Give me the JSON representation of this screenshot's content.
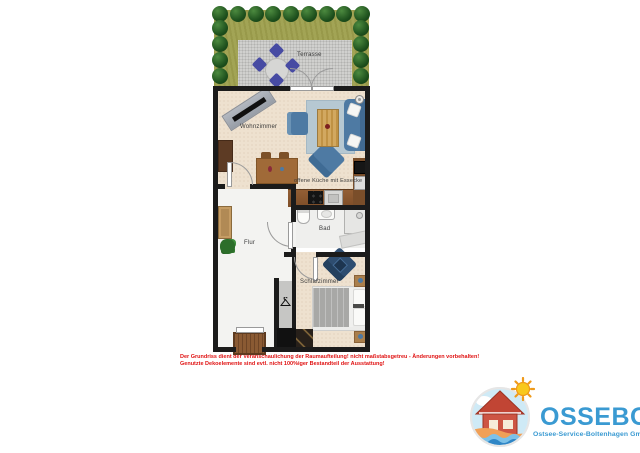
{
  "floorplan": {
    "labels": {
      "terrasse": "Terrasse",
      "wohnzimmer": "Wohnzimmer",
      "kueche": "offene Küche mit Essecke",
      "flur": "Flur",
      "bad": "Bad",
      "schlafzimmer": "Schlafzimmer"
    }
  },
  "disclaimer": {
    "line1": "Der Grundriss dient der Veranschaulichung der Raumaufteilung! nicht maßstabsgetreu - Änderungen vorbehalten!",
    "line2": "Genutzte Dekoelemente sind evtl. nicht 100%iger Bestandteil der Ausstattung!",
    "color": "#e01212"
  },
  "logo": {
    "wordmark": "OSSEBO",
    "subtitle": "Ostsee-Service-Boltenhagen GmbH",
    "brand_color": "#3a9ad2"
  },
  "icons": {
    "hanger": "coat-hanger",
    "sun": "sun",
    "ceiling_lamp": "ceiling-lamp",
    "plant": "potted-plant"
  },
  "colors": {
    "wall": "#1b1b1b",
    "floor_beige": "#eee1cf",
    "floor_light": "#f3f3f1",
    "furniture_blue": "#4e7aa3",
    "terrace_chair_blue": "#474ba3",
    "hedge_green": "#1c4e1c",
    "kitchen_wood": "#8a5a33",
    "disclaimer_red": "#e01212",
    "logo_blue": "#3a9ad2"
  }
}
